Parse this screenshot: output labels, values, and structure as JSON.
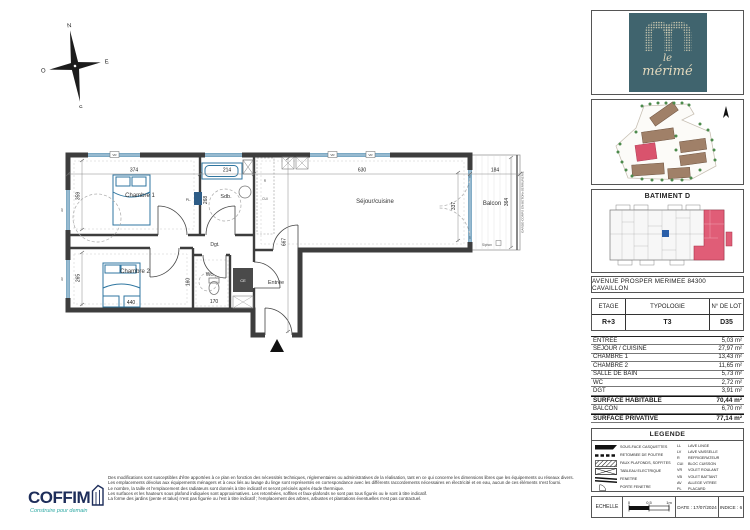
{
  "compass": {
    "n": "N",
    "e": "E",
    "s": "S",
    "o": "O"
  },
  "plan": {
    "rooms": {
      "chambre1": "Chambre 1",
      "chambre2": "Chambre 2",
      "sdb": "Sdb.",
      "dgt": "Dgt.",
      "wc": "Wc.",
      "entree": "Entrée",
      "sejour": "Séjour/cuisine",
      "balcon": "Balcon"
    },
    "dims": {
      "chambre1_w": "374",
      "sdb_w": "214",
      "sejour_w": "630",
      "balcon_w": "184",
      "chambre1_h": "359",
      "chambre2_h": "265",
      "chambre2_w": "440",
      "sdb_h": "268",
      "wc_w": "170",
      "wc_h": "160",
      "sejour_h": "337",
      "balcon_h": "364",
      "total_h": "667"
    },
    "labels": {
      "pl": "PL.",
      "ce": "CE",
      "vr": "VR",
      "av": "AV",
      "r": "R",
      "cui": "CUI",
      "garde_corps": "GARDE-CORPS EN BETON+SERRURERIE",
      "siphon": "Siphon"
    }
  },
  "sidebar": {
    "logo": {
      "line1": "le",
      "line2": "mérimé"
    },
    "batiment_title": "BATIMENT D",
    "address": "AVENUE PROSPER MERIMEE 84300 CAVAILLON",
    "lot_table": {
      "headers": [
        "ETAGE",
        "TYPOLOGIE",
        "N° DE LOT"
      ],
      "values": [
        "R+3",
        "T3",
        "D35"
      ]
    },
    "surface_table": {
      "rows": [
        {
          "label": "ENTREE",
          "value": "5,03 m²"
        },
        {
          "label": "SEJOUR / CUISINE",
          "value": "27,97 m²"
        },
        {
          "label": "CHAMBRE 1",
          "value": "13,43 m²"
        },
        {
          "label": "CHAMBRE 2",
          "value": "11,65 m²"
        },
        {
          "label": "SALLE DE BAIN",
          "value": "5,73 m²"
        },
        {
          "label": "WC",
          "value": "2,72 m²"
        },
        {
          "label": "DGT",
          "value": "3,91 m²"
        },
        {
          "label": "SURFACE HABITABLE",
          "value": "70,44 m²"
        },
        {
          "label": "BALCON",
          "value": "6,70 m²"
        },
        {
          "label": "SURFACE PRIVATIVE",
          "value": "77,14 m²"
        }
      ]
    },
    "legend": {
      "title": "LEGENDE",
      "symbols": [
        {
          "label": "SOUS-FACE CASQUETTES"
        },
        {
          "label": "RETOMBEE DE POUTRE"
        },
        {
          "label": "FAUX PLAFONDS, SOFFITES"
        },
        {
          "label": "TABLEAU ELECTRIQUE"
        },
        {
          "label": "FENETRE"
        },
        {
          "label": "PORTE FENETRE"
        }
      ],
      "abbrs": [
        {
          "abbr": "LL",
          "label": "LAVE LINGE"
        },
        {
          "abbr": "LV",
          "label": "LAVE VAISSELLE"
        },
        {
          "abbr": "R",
          "label": "REFRIGERATEUR"
        },
        {
          "abbr": "CUI",
          "label": "BLOC CUISSON"
        },
        {
          "abbr": "VR",
          "label": "VOLET ROULANT"
        },
        {
          "abbr": "VB",
          "label": "VOLET BATTANT"
        },
        {
          "abbr": "AV",
          "label": "ALLEGE VITREE"
        },
        {
          "abbr": "PL",
          "label": "PLACARD"
        }
      ]
    },
    "footer_bar": {
      "echelle": "ECHELLE",
      "ticks": [
        "0",
        "0,5",
        "1m"
      ],
      "date": "DATE : 17/07/2024",
      "indice": "INDICE : 6"
    }
  },
  "footer": {
    "brand": "COFFIM",
    "tagline": "Construire pour demain",
    "disclaimer": [
      "Des modifications sont susceptibles d'être apportées à ce plan en fonction des nécessités techniques, réglementaires ou administratives de la réalisation, tant en ce qui concerne les dimensions libres que les équipements ou réseaux divers.",
      "Les emplacements dévolus aux équipements ménagers et à ceux liés au lavage du linge sont représentés en correspondance avec les différents raccordements nécessaires en électricité et en eau, aucun de ces éléments n'est fourni.",
      "Le nombre, la taille et l'emplacement des radiateurs sont donnés à titre indicatif et seront précisés après étude thermique.",
      "Les surfaces et les hauteurs sous plafond indiquées sont approximatives. Les retombées, soffites et faux-plafonds ne sont pas tous figurés ou le sont à titre indicatif.",
      "La forme des jardins (pente et talus) n'est pas figurée ou l'est à titre indicatif ; l'emplacement des arbres, arbustes et plantations éventuelles n'est pas contractuel."
    ]
  },
  "colors": {
    "teal_logo": "#40646e",
    "cream": "#e3d9bd",
    "pink": "#d9536d",
    "navy": "#1d2d5a",
    "tagline_teal": "#2ea9a4",
    "wall": "#3d3d3d",
    "window": "#2f76a0"
  }
}
